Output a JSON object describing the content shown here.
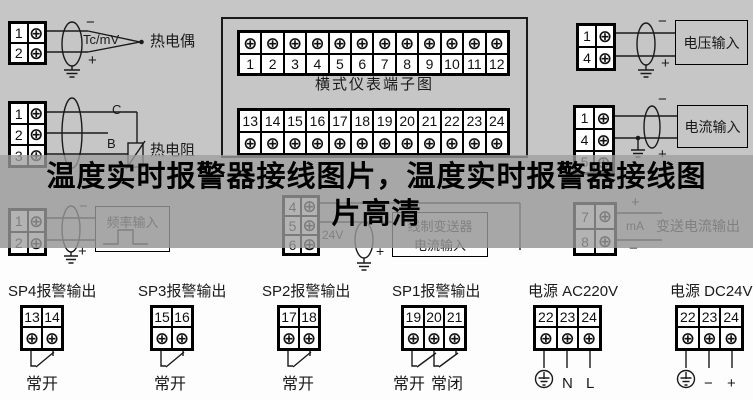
{
  "banner": {
    "title_line1": "温度实时报警器接线图片，温度实时报警器接线图",
    "title_line2": "片高清"
  },
  "glyphs": {
    "screw": "⊕"
  },
  "colors": {
    "bg_top": "#c6c6c6",
    "banner_overlay": "rgba(157,157,157,0.78)",
    "line": "#1a1a1a",
    "bg_bottom": "#fdfdfd"
  },
  "thermocouple": {
    "terminals": [
      "1",
      "2"
    ],
    "neg": "−",
    "pos": "+",
    "wire_type": "Tc/mV",
    "label": "热电偶"
  },
  "rtd": {
    "terminals": [
      "1",
      "2",
      "3"
    ],
    "wire_c": "C",
    "wire_b": "B",
    "label": "热电阻"
  },
  "frequency": {
    "terminals": [
      "1",
      "2"
    ],
    "neg": "−",
    "pos": "+",
    "box_label": "频率输入"
  },
  "terminal_diagram": {
    "title": "横式仪表端子图",
    "top_row": [
      "1",
      "2",
      "3",
      "4",
      "5",
      "6",
      "7",
      "8",
      "9",
      "10",
      "11",
      "12"
    ],
    "bottom_row": [
      "13",
      "14",
      "15",
      "16",
      "17",
      "18",
      "19",
      "20",
      "21",
      "22",
      "23",
      "24"
    ]
  },
  "voltage_input": {
    "terminals": [
      "1",
      "4"
    ],
    "neg": "−",
    "pos": "+",
    "box_label": "电压输入"
  },
  "current_input": {
    "terminals": [
      "1",
      "4",
      "5"
    ],
    "neg": "−",
    "pos": "+",
    "box_label": "电流输入"
  },
  "transmitter": {
    "terminals": [
      "4",
      "5",
      "6"
    ],
    "supply": "24V",
    "pos": "+",
    "box_line1": "线制变送器",
    "box_line2": "电流输入"
  },
  "current_output": {
    "terminals": [
      "7",
      "8"
    ],
    "pos": "+",
    "unit": "mA",
    "neg": "−",
    "label": "变送电流输出"
  },
  "outputs": [
    {
      "label": "SP4报警输出",
      "terminals": [
        "13",
        "14"
      ],
      "contact1": "常开",
      "contact2": ""
    },
    {
      "label": "SP3报警输出",
      "terminals": [
        "15",
        "16"
      ],
      "contact1": "常开",
      "contact2": ""
    },
    {
      "label": "SP2报警输出",
      "terminals": [
        "17",
        "18"
      ],
      "contact1": "常开",
      "contact2": ""
    },
    {
      "label": "SP1报警输出",
      "terminals": [
        "19",
        "20",
        "21"
      ],
      "contact1": "常开",
      "contact2": "常闭"
    }
  ],
  "power": [
    {
      "label": "电源 AC220V",
      "terminals": [
        "22",
        "23",
        "24"
      ],
      "mark1": "N",
      "mark2": "L"
    },
    {
      "label": "电源 DC24V",
      "terminals": [
        "22",
        "23",
        "24"
      ],
      "mark1": "−",
      "mark2": "+"
    }
  ]
}
